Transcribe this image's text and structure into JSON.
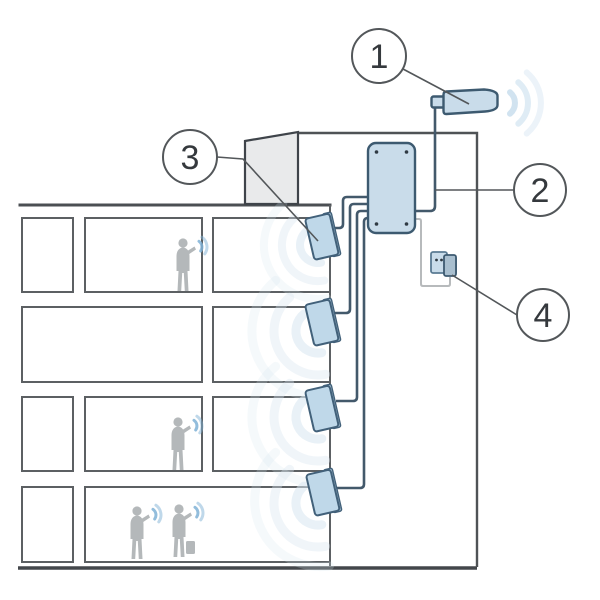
{
  "diagram": {
    "kind": "building-cellular-signal-booster-schematic",
    "callouts": [
      {
        "number": "1",
        "target": "outdoor-donor-antenna"
      },
      {
        "number": "2",
        "target": "signal-amplifier-unit"
      },
      {
        "number": "3",
        "target": "indoor-panel-antenna"
      },
      {
        "number": "4",
        "target": "power-outlet"
      }
    ],
    "counts": {
      "indoor_antennas": 4,
      "floors": 4,
      "people": 4
    },
    "colors": {
      "device_fill": "#c9dcea",
      "device_stroke": "#3d5a70",
      "structure_line": "#55595c",
      "signal_wave": "#b9d4e8",
      "silhouette": "#b4b8ba",
      "rooftop_structure_fill": "#e9eaeb",
      "background": "#ffffff"
    }
  }
}
